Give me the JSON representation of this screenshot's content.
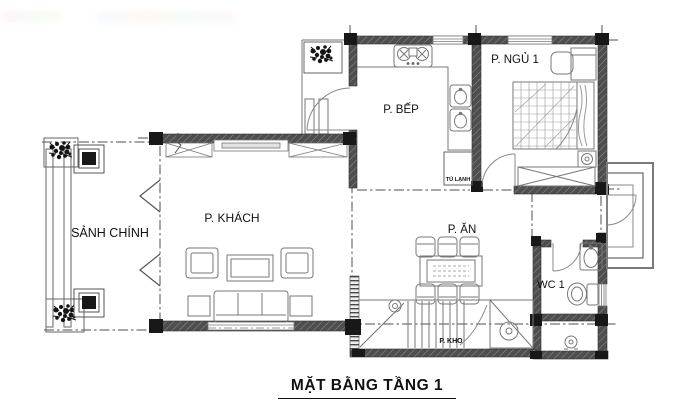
{
  "title": {
    "text": "MẶT BẰNG TẦNG 1"
  },
  "rooms": {
    "main_hall": "SẢNH CHÍNH",
    "living_room": "P. KHÁCH",
    "kitchen": "P. BẾP",
    "bedroom_1": "P. NGỦ 1",
    "dining_room": "P. ĂN",
    "wc_1": "WC 1",
    "storage": "P. KHO",
    "fridge": "TỦ LẠNH"
  },
  "colors": {
    "background": "#ffffff",
    "wall": "#4e4e4e",
    "column": "#181818",
    "thin_line": "#777777",
    "text": "#111111"
  }
}
